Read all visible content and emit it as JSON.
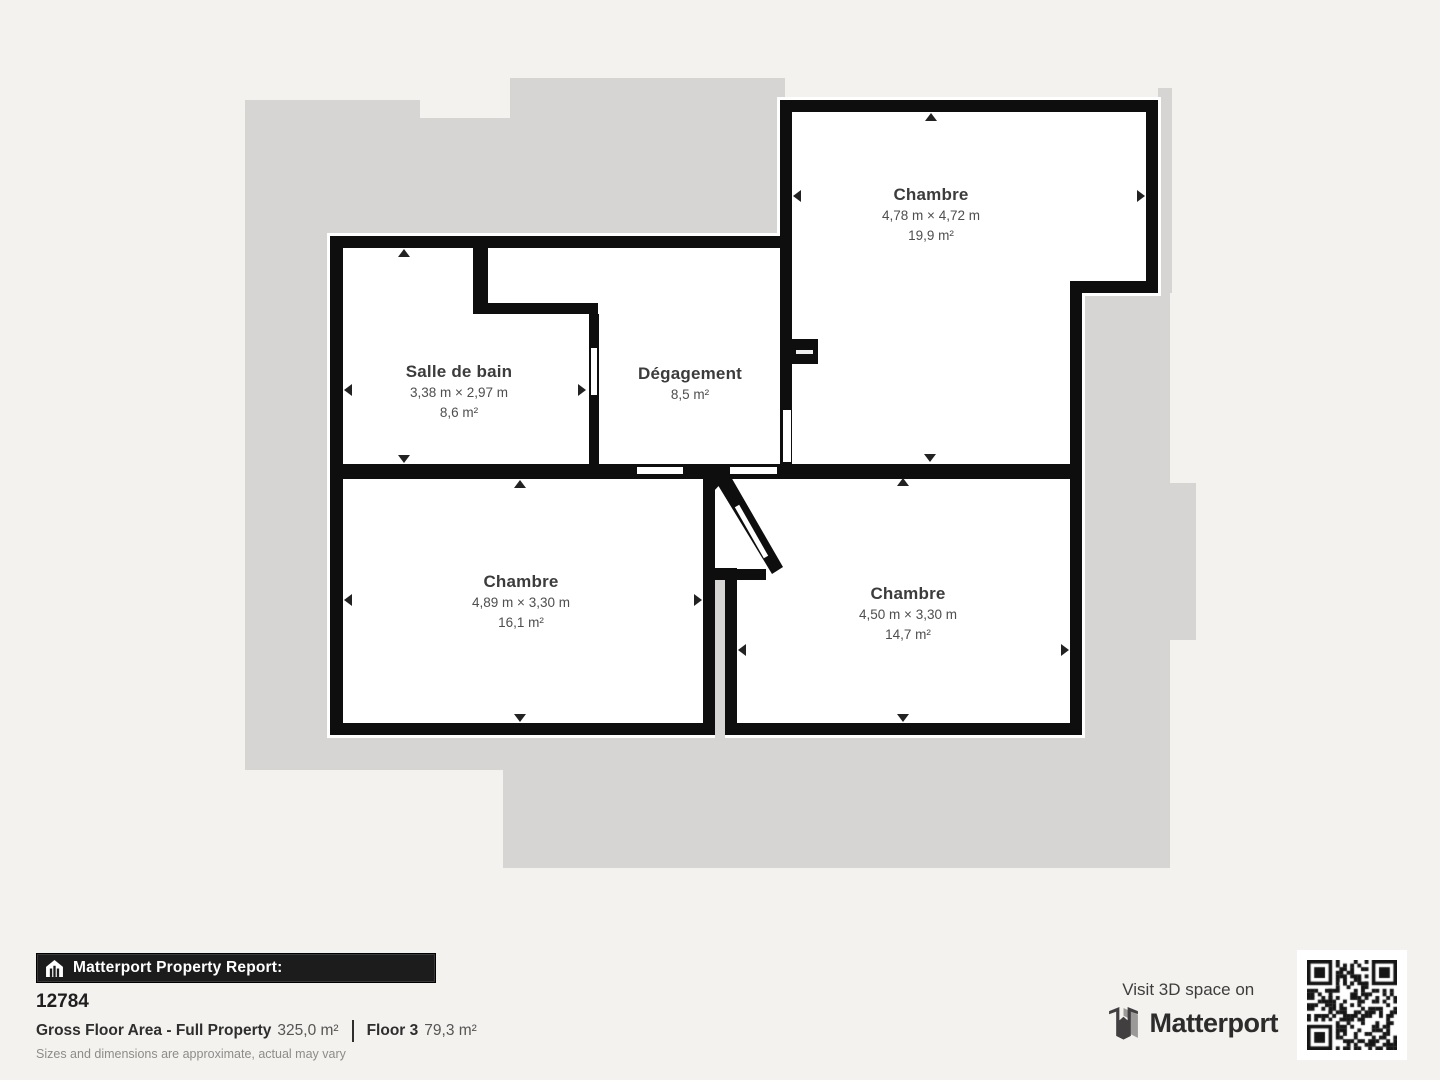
{
  "plan": {
    "rooms": [
      {
        "id": "chambre-top-right",
        "name": "Chambre",
        "dims": "4,78 m × 4,72 m",
        "area": "19,9 m²"
      },
      {
        "id": "salle-de-bain",
        "name": "Salle de bain",
        "dims": "3,38 m × 2,97 m",
        "area": "8,6 m²"
      },
      {
        "id": "degagement",
        "name": "Dégagement",
        "dims": "",
        "area": "8,5 m²"
      },
      {
        "id": "chambre-bottom-left",
        "name": "Chambre",
        "dims": "4,89 m × 3,30 m",
        "area": "16,1 m²"
      },
      {
        "id": "chambre-bottom-right",
        "name": "Chambre",
        "dims": "4,50 m × 3,30 m",
        "area": "14,7 m²"
      }
    ]
  },
  "footer": {
    "report_label": "Matterport Property Report:",
    "property_id": "12784",
    "gfa_label": "Gross Floor Area - Full Property",
    "gfa_value": "325,0 m²",
    "floor_label": "Floor 3",
    "floor_value": "79,3 m²",
    "disclaimer": "Sizes and dimensions are approximate, actual may vary",
    "visit_text": "Visit 3D space on",
    "brand": "Matterport"
  },
  "colors": {
    "page_bg": "#f4f2ef",
    "underlay_gray": "#d7d5d3",
    "wall_black": "#0e0e0e",
    "label_text": "#3c3c3c",
    "bar_bg": "#1d1c1c"
  }
}
